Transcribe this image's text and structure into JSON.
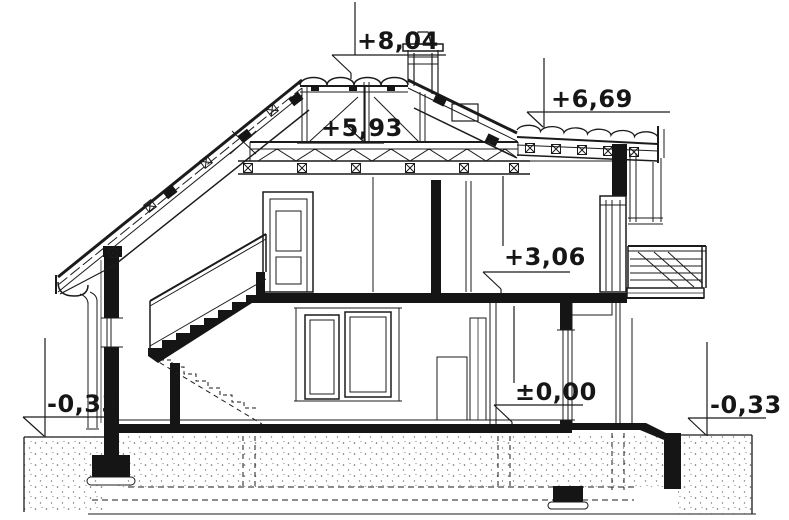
{
  "drawing": {
    "type": "architectural cross-section of a house",
    "background_color": "#ffffff",
    "ink_color": "#1b1b1b",
    "elevation_markers": [
      {
        "id": "ridge",
        "label": "+8,04"
      },
      {
        "id": "secondary-roof",
        "label": "+6,69"
      },
      {
        "id": "attic-collar",
        "label": "+5,93"
      },
      {
        "id": "first-floor",
        "label": "+3,06"
      },
      {
        "id": "ground-floor",
        "label": "±0,00"
      },
      {
        "id": "ground-level-left",
        "label": "-0,33"
      },
      {
        "id": "ground-level-right",
        "label": "-0,33"
      }
    ]
  }
}
